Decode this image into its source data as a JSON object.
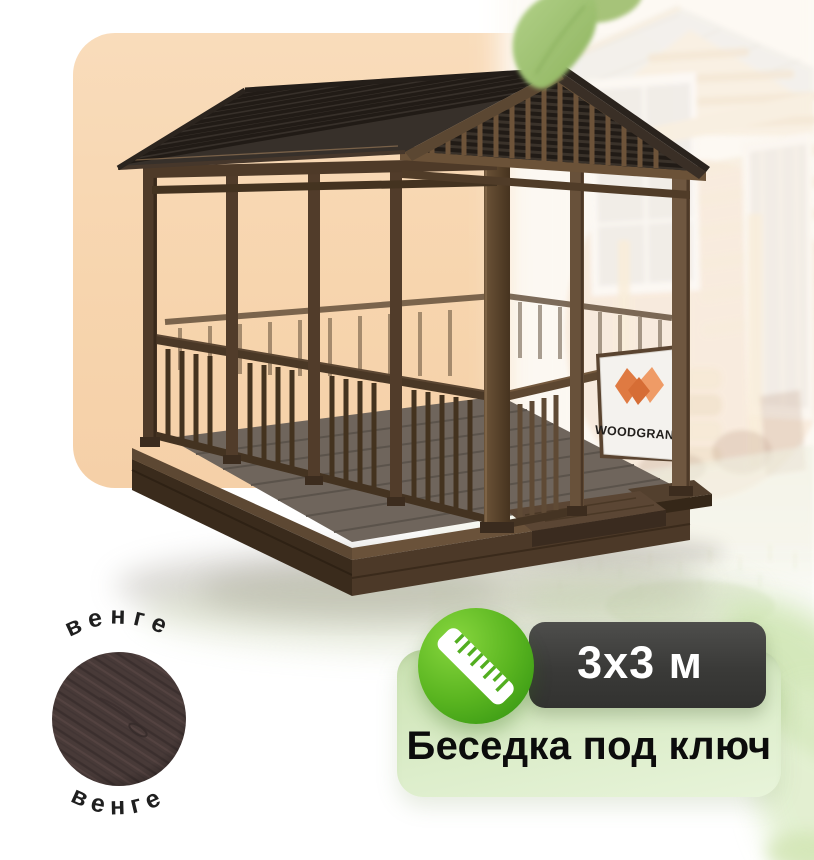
{
  "brand_sign": {
    "label": "WOODGRAND",
    "logo_icon": "woodgrand-w-logo",
    "logo_color": "#e07b42"
  },
  "material_swatch": {
    "top_label": "венге",
    "bottom_label": "венге",
    "swatch_color": "#483a38"
  },
  "size_badge": {
    "label": "3x3 м",
    "icon": "ruler-icon",
    "bg": "#3d3d3b",
    "accent": "#55b122"
  },
  "title_badge": {
    "label": "Беседка под ключ",
    "bg": "#daecc5"
  },
  "decor": {
    "top_icon": "leaf-icon",
    "corner_icon": "blurred-leaf-icon"
  },
  "colors": {
    "peach_backdrop": "#f8d7b3",
    "roof_wood": "#332b25",
    "frame_wood": "#5e4731",
    "deck_floor": "#6f655c"
  }
}
